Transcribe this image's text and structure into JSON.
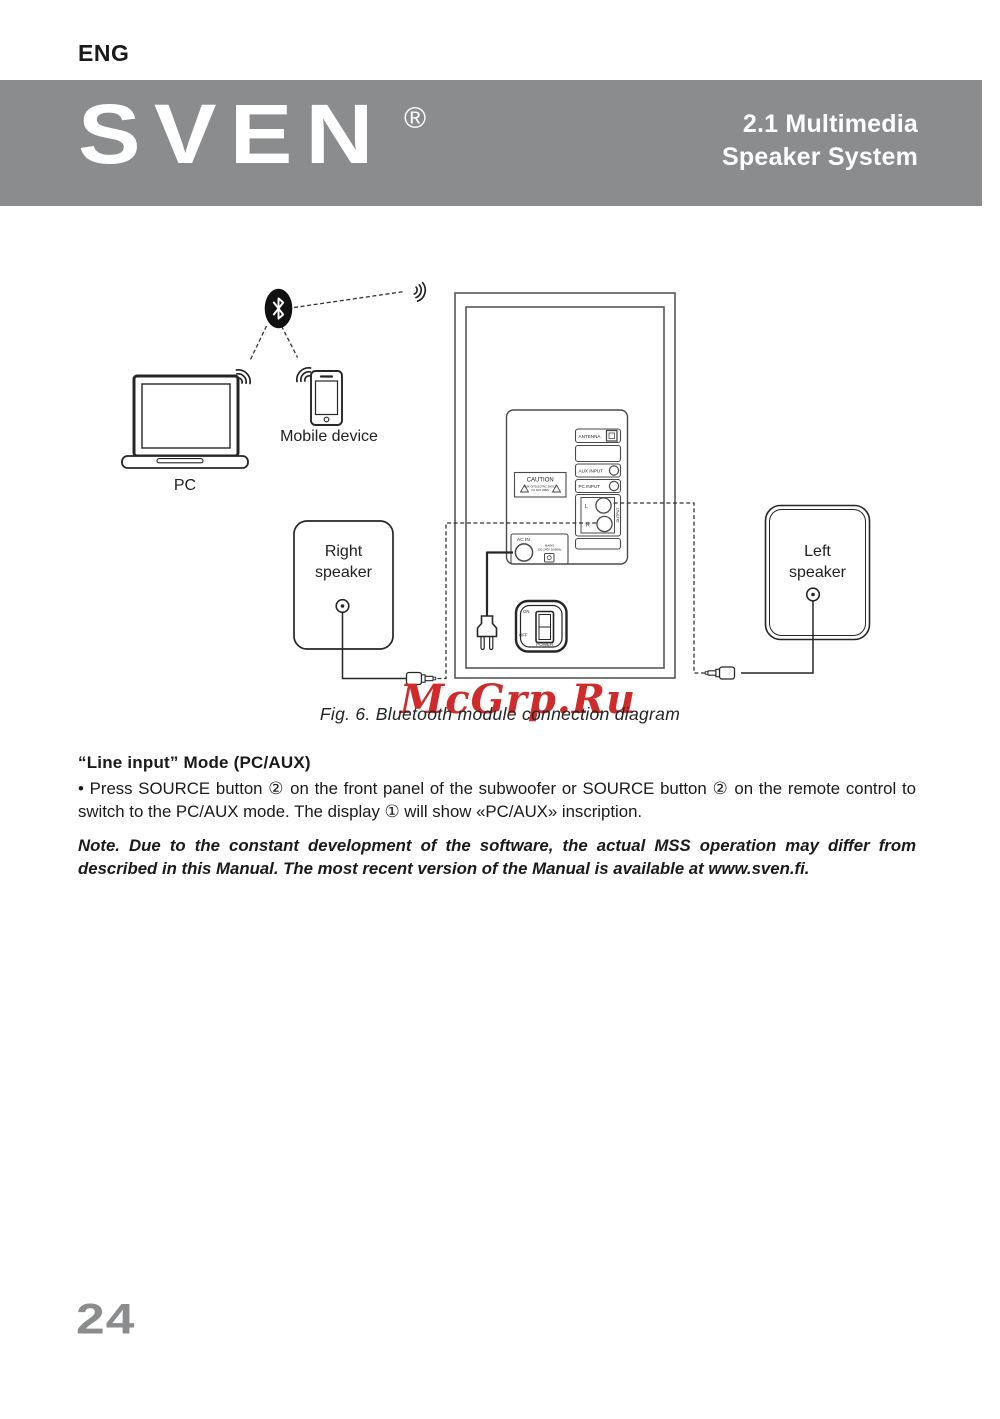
{
  "page": {
    "lang_label": "ENG",
    "page_number": "24"
  },
  "banner": {
    "brand": "SVEN",
    "registered": "®",
    "title_line1": "2.1 Multimedia",
    "title_line2": "Speaker System",
    "bg_color": "#8a8c8e"
  },
  "diagram": {
    "caption": "Fig. 6. Bluetooth module connection diagram",
    "watermark": {
      "text": "McGrp.Ru",
      "color": "#cf2b2b"
    },
    "labels": {
      "pc": "PC",
      "mobile": "Mobile device",
      "right_speaker": [
        "Right",
        "speaker"
      ],
      "left_speaker": [
        "Left",
        "speaker"
      ],
      "antenna": "ANTENNA",
      "aux_input": "AUX INPUT",
      "pc_input": "PC INPUT",
      "l": "L",
      "r": "R",
      "output": "OUTPUT",
      "caution": "CAUTION",
      "caution_small": [
        "RISK OF ELECTRIC SHOCK",
        "DO NOT OPEN"
      ],
      "ac_in": "AC IN",
      "mains": [
        "MAINS",
        "220-240V 50/60Hz"
      ],
      "on": "ON",
      "off": "OFF",
      "power": "POWER"
    }
  },
  "content": {
    "section_heading": "“Line input” Mode (PC/AUX)",
    "bullet_marker": "•",
    "bullet_text": "Press SOURCE button ② on the front panel of the subwoofer or SOURCE button ② on the remote control to switch to the PC/AUX mode. The display ① will show «PC/AUX» inscription.",
    "note_text": "Note. Due to the constant development of the software, the actual MSS operation may differ from described in this Manual. The most recent version of the Manual is available at www.sven.fi."
  }
}
